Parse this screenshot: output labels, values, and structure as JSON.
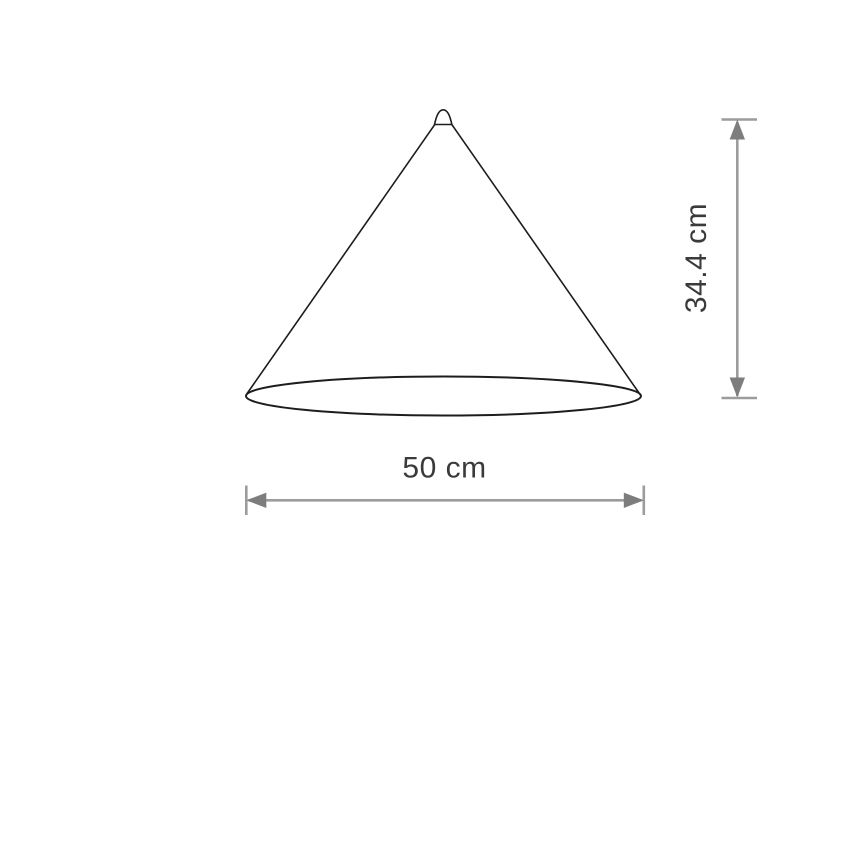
{
  "diagram": {
    "height_dimension": {
      "value": 34.4,
      "unit": "cm",
      "label": "34.4 cm"
    },
    "width_dimension": {
      "value": 50,
      "unit": "cm",
      "label": "50 cm"
    },
    "colors": {
      "outline": "#1d1d1b",
      "dimension_stem": "#9c9c9c",
      "dimension_arrow": "#7d7d7d",
      "dimension_text": "#3a3a3a",
      "background": "#ffffff"
    }
  }
}
